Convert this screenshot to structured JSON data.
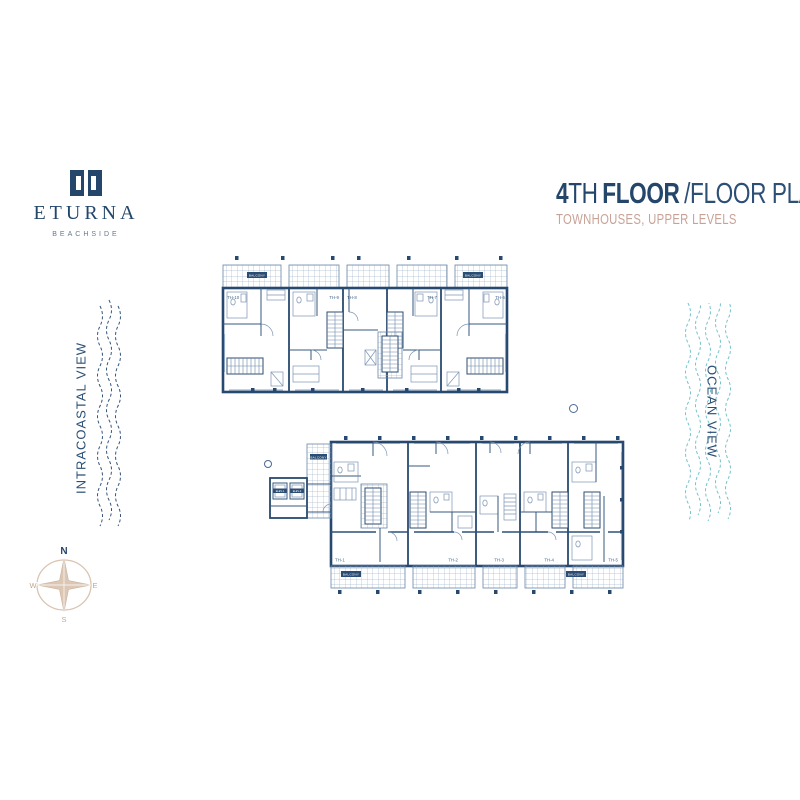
{
  "brand": {
    "name": "ETURNA",
    "tagline": "BEACHSIDE"
  },
  "header": {
    "floor_number": "4",
    "floor_suffix": "TH",
    "title_bold": "FLOOR",
    "title_light": "/FLOOR PLANS",
    "subtitle": "TOWNHOUSES, UPPER LEVELS"
  },
  "views": {
    "left": "INTRACOASTAL VIEW",
    "right": "OCEAN VIEW"
  },
  "compass": {
    "n": "N",
    "e": "E",
    "s": "S",
    "w": "W"
  },
  "plans": {
    "upper": {
      "units": [
        "TH-10",
        "TH-9",
        "TH-8",
        "TH-7",
        "TH-6"
      ],
      "balcony_tag_left": "BALCONY",
      "balcony_tag_right": "BALCONY"
    },
    "lower": {
      "units": [
        "TH-1",
        "TH-2",
        "TH-3",
        "TH-4",
        "TH-5"
      ],
      "balcony_tag_left": "BALCONY",
      "balcony_tag_right": "BALCONY",
      "walkway_tag": "BALCONY",
      "elevators": [
        "ELEV-1",
        "ELEV-2"
      ]
    }
  },
  "colors": {
    "navy": "#24466b",
    "plan_line": "#27496f",
    "salmon": "#c9a296",
    "teal": "#74c3cd",
    "compass_tan": "#dcc7b5"
  }
}
